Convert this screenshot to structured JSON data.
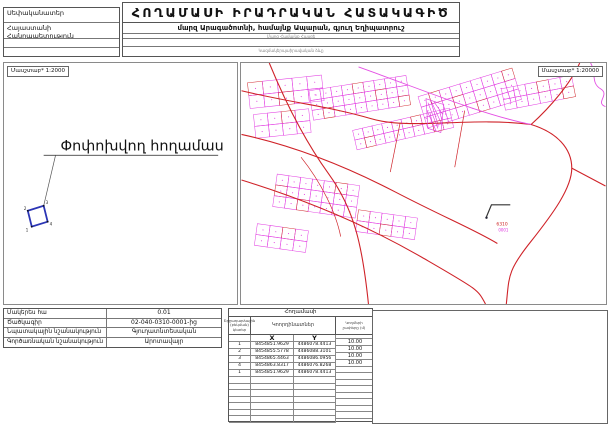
{
  "header": {
    "title": "ՀՈՂԱՄԱՍԻ ԻՐԱԴՐԱԿԱՆ ՀԱՏԱԿԱԳԻԾ",
    "address_line": "մարզ Արագածոտնի, համայնք Ապարան, գյուղ Եղիպատրուշ",
    "address_caption": "Մարզ Համայնք Հասցե",
    "org_caption": "Կազմակերպաիրավական ձևը",
    "owner_label": "Սեփականատեր",
    "owner_value": "Հայաստանի Հանրապետություն"
  },
  "left_panel": {
    "scale_label": "Մասշտաբ* 1:2000",
    "plot_label": "Փոփոխվող հողամաս",
    "vertices": [
      "1",
      "2",
      "3",
      "4"
    ]
  },
  "map_panel": {
    "scale_label": "Մասշտաբ* 1:20000",
    "code_red": "6310",
    "code_magenta": "0001",
    "colors": {
      "parcel_magenta": "#e23ce2",
      "road_red": "#cf2228",
      "plot_blue": "#2b35b5"
    }
  },
  "info_table": {
    "rows": [
      {
        "label": "Մակերես հա",
        "value": "0.01"
      },
      {
        "label": "Ծածկագիր",
        "value": "02-040-0310-0001-ից"
      },
      {
        "label": "Նպատակային նշանակություն",
        "value": "Գյուղատնտեսական"
      },
      {
        "label": "Գործառնական նշանակություն",
        "value": "Արոտավայր"
      }
    ]
  },
  "coords_table": {
    "title": "Հողամասի",
    "points_header": "Շրջադարձային (բեկման) կետեր",
    "coords_header": "Կոորդինատներ",
    "sides_header": "Կողմերի չափերը (մ)",
    "x_label": "X",
    "y_label": "Y",
    "rows": [
      {
        "n": "1",
        "x": "8454851.9629",
        "y": "4486078.4413"
      },
      {
        "n": "2",
        "x": "8454855.5778",
        "y": "4486088.3101"
      },
      {
        "n": "3",
        "x": "8454865.4463",
        "y": "4486086.0956"
      },
      {
        "n": "4",
        "x": "8454863.8317",
        "y": "4486076.8268"
      },
      {
        "n": "1",
        "x": "8454851.9629",
        "y": "4486078.4413"
      }
    ],
    "side_lengths": [
      "10.00",
      "10.00",
      "10.00",
      "10.00"
    ],
    "empty_row_count": 7
  }
}
